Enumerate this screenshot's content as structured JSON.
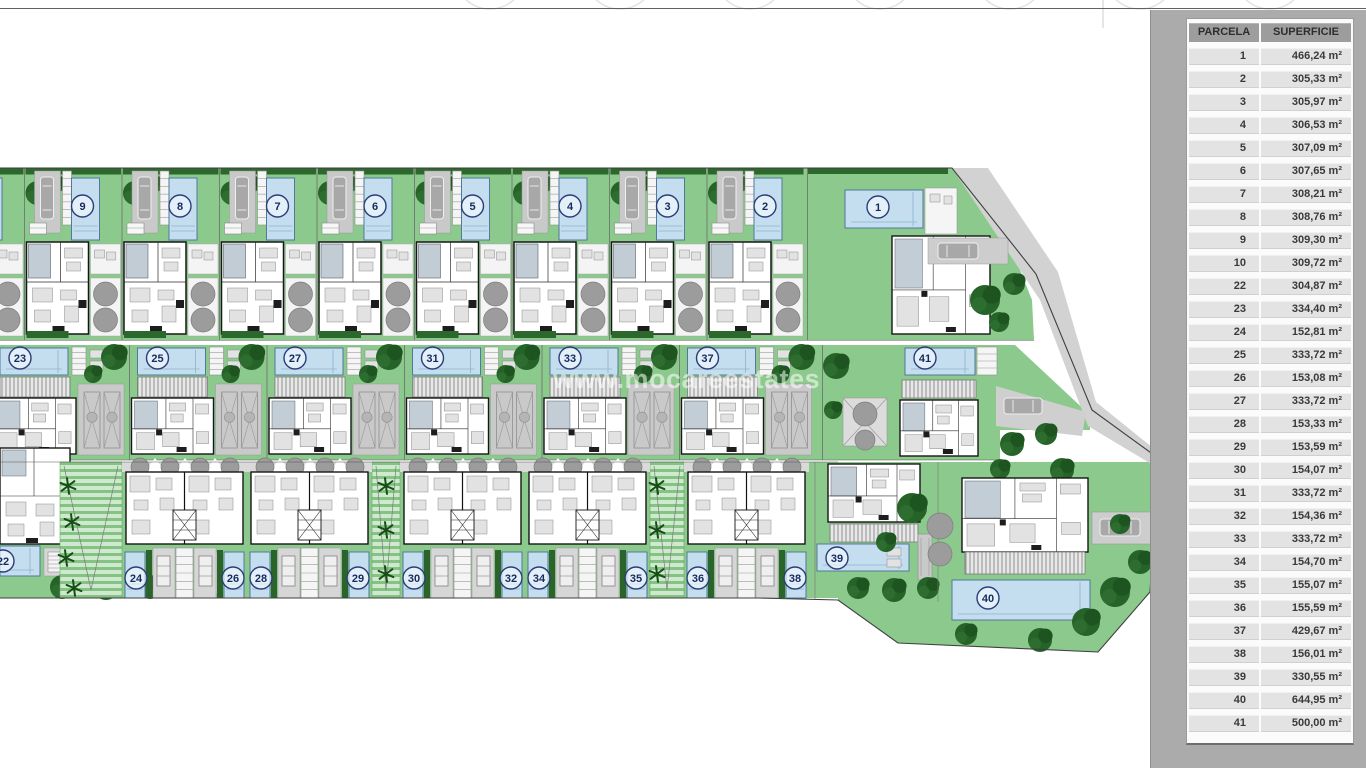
{
  "plan": {
    "watermark": "www.mocareestates",
    "top_row": [
      "9",
      "8",
      "7",
      "6",
      "5",
      "4",
      "3",
      "2"
    ],
    "top_right": "1",
    "middle_row": [
      "23",
      "25",
      "27",
      "31",
      "33",
      "37"
    ],
    "middle_right": "41",
    "bottom_left": "22",
    "bottom_blocks": [
      [
        "24",
        "26"
      ],
      [
        "28",
        "29"
      ],
      [
        "30",
        "32"
      ],
      [
        "34",
        "35"
      ],
      [
        "36",
        "38"
      ]
    ],
    "bottom_right": [
      "39",
      "40"
    ]
  },
  "colors": {
    "plot_green": "#8cc98c",
    "tree_green": "#266328",
    "pool_blue": "#c4ddef",
    "pool_edge": "#50799c",
    "panel_gray": "#ababab",
    "header_gray": "#9d9d9d",
    "row_gray": "#e3e3e3",
    "road_gray": "#cfcfcf",
    "marker_ring": "#2a3d77"
  },
  "table": {
    "columns": [
      "PARCELA",
      "SUPERFICIE"
    ],
    "rows": [
      [
        "1",
        "466,24 m²"
      ],
      [
        "2",
        "305,33 m²"
      ],
      [
        "3",
        "305,97 m²"
      ],
      [
        "4",
        "306,53 m²"
      ],
      [
        "5",
        "307,09 m²"
      ],
      [
        "6",
        "307,65 m²"
      ],
      [
        "7",
        "308,21 m²"
      ],
      [
        "8",
        "308,76 m²"
      ],
      [
        "9",
        "309,30 m²"
      ],
      [
        "10",
        "309,72 m²"
      ],
      [
        "22",
        "304,87 m²"
      ],
      [
        "23",
        "334,40 m²"
      ],
      [
        "24",
        "152,81 m²"
      ],
      [
        "25",
        "333,72 m²"
      ],
      [
        "26",
        "153,08 m²"
      ],
      [
        "27",
        "333,72 m²"
      ],
      [
        "28",
        "153,33 m²"
      ],
      [
        "29",
        "153,59 m²"
      ],
      [
        "30",
        "154,07 m²"
      ],
      [
        "31",
        "333,72 m²"
      ],
      [
        "32",
        "154,36 m²"
      ],
      [
        "33",
        "333,72 m²"
      ],
      [
        "34",
        "154,70 m²"
      ],
      [
        "35",
        "155,07 m²"
      ],
      [
        "36",
        "155,59 m²"
      ],
      [
        "37",
        "429,67 m²"
      ],
      [
        "38",
        "156,01 m²"
      ],
      [
        "39",
        "330,55 m²"
      ],
      [
        "40",
        "644,95 m²"
      ],
      [
        "41",
        "500,00 m²"
      ]
    ]
  }
}
